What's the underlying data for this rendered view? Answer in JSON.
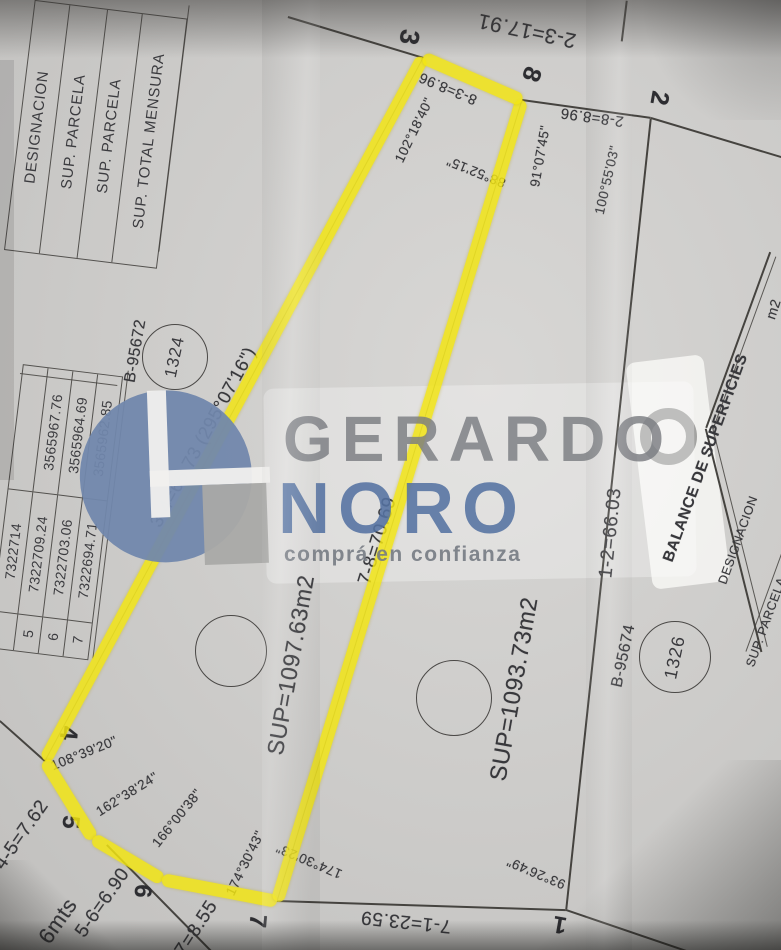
{
  "watermark": {
    "name_top": "GERARDO",
    "name_bottom": "NORO",
    "slogan": "comprá en confianza"
  },
  "header_table": {
    "col1": "DESIGNACION",
    "col2": "SUP. PARCELA",
    "col3": "SUP. PARCELA",
    "col4": "SUP. TOTAL MENSURA"
  },
  "coord_table": {
    "rows": [
      {
        "pt": "",
        "x": "7322714",
        "y": ""
      },
      {
        "pt": "5",
        "x": "7322709.24",
        "y": "3565967.76"
      },
      {
        "pt": "6",
        "x": "7322703.06",
        "y": "3565964.69"
      },
      {
        "pt": "7",
        "x": "7322694.71",
        "y": "3565962.85"
      }
    ]
  },
  "balance_table": {
    "title": "BALANCE DE SUPERFICIES",
    "designacion": "DESIGNACION",
    "sup_parcela": "SUP. PARCELA",
    "unit": "m2"
  },
  "parcel_a": {
    "area": "SUP=1097.63m2",
    "registry": "B-95672",
    "lot": "1324"
  },
  "parcel_b": {
    "area": "SUP=1093.73m2",
    "registry": "B-95674",
    "lot": "1326"
  },
  "vertex": {
    "v1": "1",
    "v2": "2",
    "v3": "3",
    "v4": "4",
    "v5": "5",
    "v6": "6",
    "v7": "7",
    "v8": "8"
  },
  "dims": {
    "d23": "2-3=17.91",
    "d28": "2-8=8.96",
    "d38": "8-3=8.96",
    "d34": "3-4=66.73 (295°07'16\")",
    "d45": "4-5=7.62",
    "d56": "5-6=6.90",
    "d67": "6-7=8.55",
    "d78": "7-8=70.69",
    "d71": "7-1=23.59",
    "d12": "1-2=66.03",
    "street": "6mts"
  },
  "angles": {
    "a102": "102°18'40\"",
    "a88": "88°52'15\"",
    "a91": "91°07'45\"",
    "a100": "100°55'03\"",
    "a108": "108°39'20\"",
    "a162": "162°38'24\"",
    "a166": "166°00'38\"",
    "a174a": "174°30'43\"",
    "a174b": "174°30'23\"",
    "a93": "93°26'49\""
  }
}
